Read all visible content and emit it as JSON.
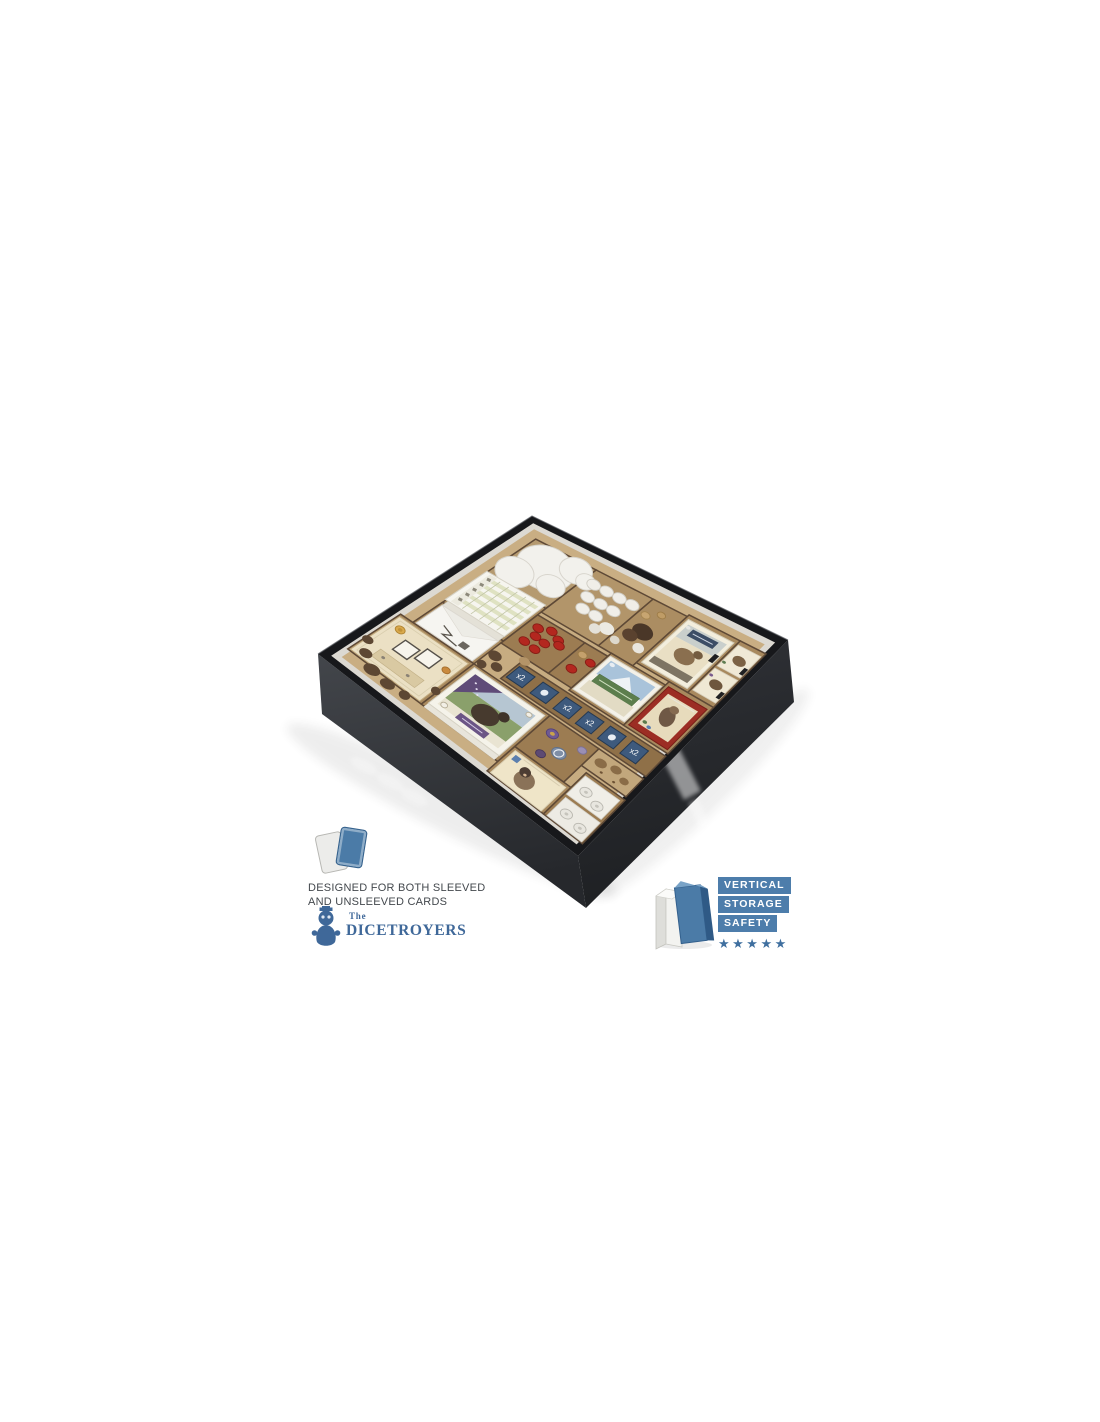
{
  "photo": {
    "description": "Black board game box with laser-cut wooden insert organizer holding cards, tokens, dice tiles, score pads, punchboards and a cloth bag",
    "box_black": "#17181b",
    "wall_gray_top": "#43464b",
    "wall_gray_bottom": "#26282c",
    "wood_light": "#c9ae83",
    "wood_floor": "#c7ac81",
    "well_dark": "#a8895e",
    "red_chip": "#b3271f",
    "dice_blue": "#3e5a7d",
    "dice_label": "x2"
  },
  "badges": {
    "sleeve_info": {
      "line1": "DESIGNED FOR BOTH SLEEVED",
      "line2": "AND UNSLEEVED CARDS",
      "card_blue": "#4b7ba7",
      "card_gray": "#ececea"
    },
    "brand": {
      "prefix": "The",
      "name": "DICETROYERS",
      "color": "#3f6899",
      "mascot_icon": "dice-monster"
    },
    "vertical_storage": {
      "labels": [
        "VERTICAL",
        "STORAGE",
        "SAFETY"
      ],
      "stars_text": "★★★★★",
      "label_bg": "#4d7dab",
      "star_color": "#3f6f9f"
    }
  }
}
